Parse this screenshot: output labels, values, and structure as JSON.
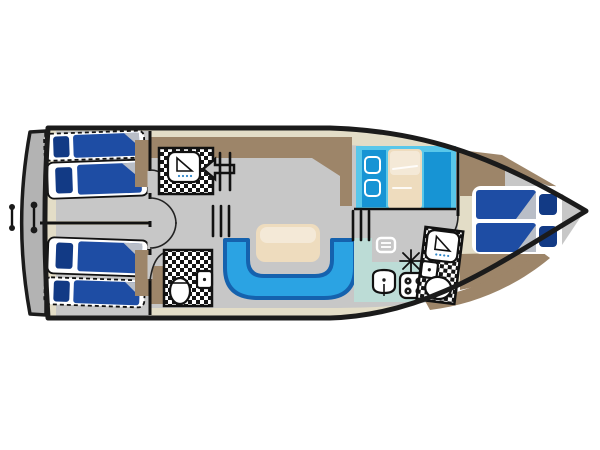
{
  "diagram": {
    "kind": "boat-floor-plan",
    "orientation": "bow-right",
    "rooms": [
      {
        "id": "aft-cabin-top",
        "type": "cabin",
        "beds": 2,
        "notes": "one berth dashed (convertible)"
      },
      {
        "id": "aft-cabin-bottom",
        "type": "cabin",
        "beds": 2,
        "notes": "one berth dashed (convertible)"
      },
      {
        "id": "shower-room",
        "type": "bathroom",
        "fixtures": [
          "shower"
        ]
      },
      {
        "id": "toilet-room",
        "type": "bathroom",
        "fixtures": [
          "toilet",
          "washbasin"
        ]
      },
      {
        "id": "saloon",
        "type": "saloon",
        "features": [
          "u-shaped-sofa",
          "table"
        ]
      },
      {
        "id": "dinette",
        "type": "dinette",
        "features": [
          "bench-seat",
          "bench-seat",
          "table"
        ]
      },
      {
        "id": "galley",
        "type": "galley",
        "features": [
          "cooler",
          "sink",
          "stove-4-burner",
          "star-symbol"
        ]
      },
      {
        "id": "bow-bathroom",
        "type": "bathroom",
        "fixtures": [
          "shower",
          "washbasin",
          "toilet"
        ]
      },
      {
        "id": "bow-cabin",
        "type": "cabin",
        "beds": 1,
        "notes": "double berth"
      }
    ],
    "deck_features": [
      "swim-platform",
      "mooring-handles",
      "companionway-arrow",
      "steps"
    ]
  },
  "colors": {
    "white": "#ffffff",
    "deck": "#e3ddc7",
    "floor": "#c7c7c7",
    "floor_dark": "#bdbdbd",
    "platform": "#b3b3b3",
    "brown": "#9d8569",
    "bed_blue": "#1e4da4",
    "pillow_navy": "#123a85",
    "fold_gray": "#b9bec7",
    "dinette_cyan": "#58c7ea",
    "bench_blue": "#1794d4",
    "table_cream": "#eedcbe",
    "seat_blue": "#2ba3e3",
    "seat_border": "#1562ae",
    "galley_teal": "#bcdcd6",
    "tile_black": "#151515",
    "shower_blue": "#2f86c8",
    "outline": "#1b1b1b"
  }
}
